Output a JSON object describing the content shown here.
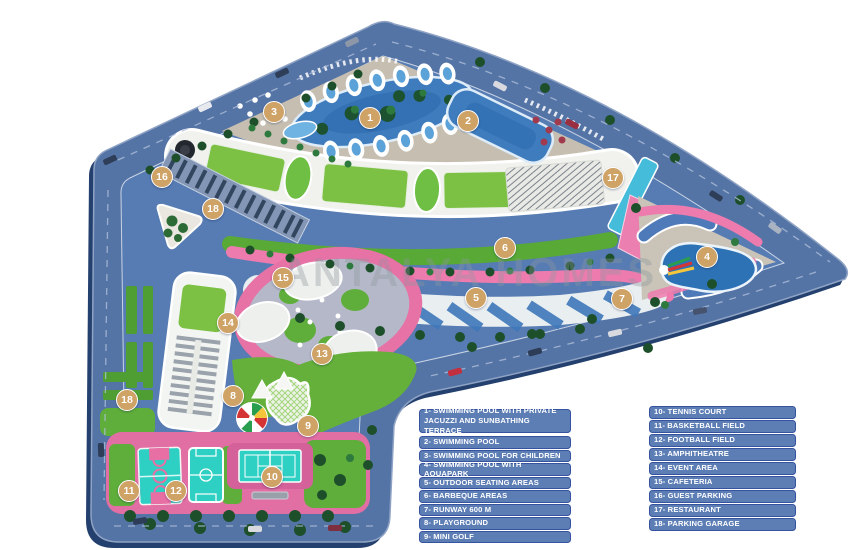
{
  "watermark": "ANTALYA HOMES",
  "legend": {
    "left": [
      "1- SWIMMING POOL WITH PRIVATE JACUZZI AND SUNBATHING TERRACE",
      "2- SWIMMING POOL",
      "3- SWIMMING POOL FOR CHILDREN",
      "4- SWIMMING POOL WITH AQUAPARK",
      "5- OUTDOOR SEATING AREAS",
      "6- BARBEQUE AREAS",
      "7- RUNWAY 600 M",
      "8- PLAYGROUND",
      "9- MINI GOLF"
    ],
    "right": [
      "10- TENNIS COURT",
      "11- BASKETBALL FIELD",
      "12- FOOTBALL FIELD",
      "13- AMPHITHEATRE",
      "14- EVENT AREA",
      "15- CAFETERIA",
      "16- GUEST PARKING",
      "17- RESTAURANT",
      "18- PARKING GARAGE"
    ]
  },
  "markers": [
    {
      "n": "1",
      "x": 370,
      "y": 118
    },
    {
      "n": "2",
      "x": 468,
      "y": 121
    },
    {
      "n": "3",
      "x": 274,
      "y": 112
    },
    {
      "n": "4",
      "x": 707,
      "y": 257
    },
    {
      "n": "5",
      "x": 476,
      "y": 298
    },
    {
      "n": "6",
      "x": 505,
      "y": 248
    },
    {
      "n": "7",
      "x": 622,
      "y": 299
    },
    {
      "n": "8",
      "x": 233,
      "y": 396
    },
    {
      "n": "9",
      "x": 308,
      "y": 426
    },
    {
      "n": "10",
      "x": 272,
      "y": 477
    },
    {
      "n": "11",
      "x": 129,
      "y": 491
    },
    {
      "n": "12",
      "x": 176,
      "y": 491
    },
    {
      "n": "13",
      "x": 322,
      "y": 354
    },
    {
      "n": "14",
      "x": 228,
      "y": 323
    },
    {
      "n": "15",
      "x": 283,
      "y": 278
    },
    {
      "n": "16",
      "x": 162,
      "y": 177
    },
    {
      "n": "17",
      "x": 613,
      "y": 178
    },
    {
      "n": "18",
      "x": 213,
      "y": 209
    },
    {
      "n": "18",
      "x": 127,
      "y": 400
    }
  ],
  "colors": {
    "legend_box": "#5d7eb5",
    "legend_border": "#35539f",
    "marker": "#cfa266",
    "road": "#5574a6",
    "interior": "#567cb3",
    "deck": "#c6bfb1",
    "water": "#3e7cbd",
    "lawn": "#5fae3b",
    "roof_green": "#7cc143",
    "pink": "#e878ab",
    "plaza": "#b5b8c8",
    "court_teal": "#2fd0c4",
    "building": "#f1f2ee"
  }
}
